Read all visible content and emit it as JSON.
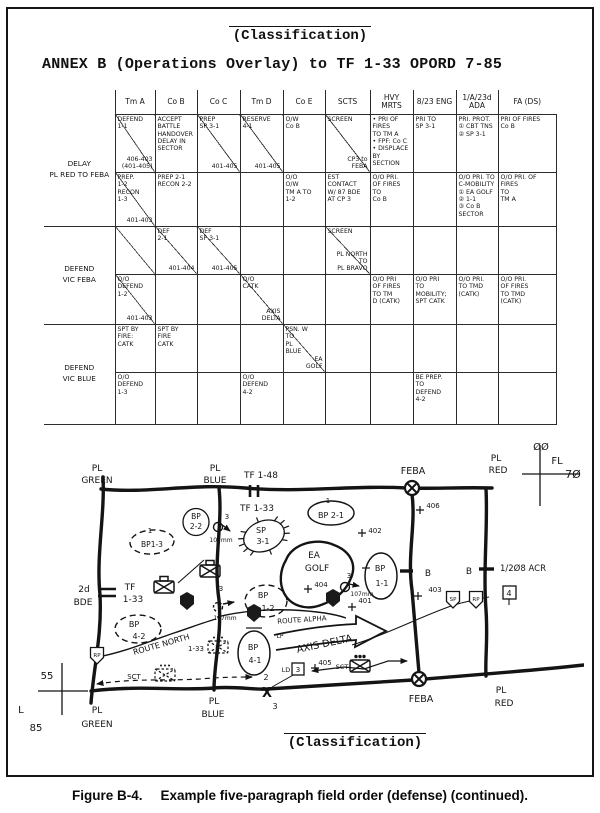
{
  "page": {
    "classification_top": "(Classification)",
    "classification_bottom": "(Classification)",
    "title": "ANNEX B (Operations Overlay) to TF 1-33 OPORD 7-85",
    "caption_label": "Figure B-4.",
    "caption_text": "Example five-paragraph field order (defense) (continued)."
  },
  "table": {
    "columns": [
      "Tm A",
      "Co B",
      "Co C",
      "Tm D",
      "Co E",
      "SCTS",
      "HVY\nMRTS",
      "8/23 ENG",
      "1/A/23d ADA",
      "FA (DS)"
    ],
    "rows": [
      {
        "label": "DELAY\nPL RED TO FEBA",
        "cells": [
          {
            "t": "DEFEND\n1-1",
            "b": "406-403\n(401-405)",
            "d": true
          },
          {
            "t": "ACCEPT\nBATTLE\nHANDOVER\nDELAY IN\nSECTOR"
          },
          {
            "t": "PREP\nSP 3-1",
            "b": "401-405",
            "d": true
          },
          {
            "t": "RESERVE\n4-1",
            "b": "401-405",
            "d": true
          },
          {
            "t": "O/W\nCo B"
          },
          {
            "t": "SCREEN",
            "b": "CP3 to\nFEBA",
            "d": true
          },
          {
            "t": "• PRI OF FIRES\n  TO TM A\n• FPF: Co C\n• DISPLACE BY\n  SECTION"
          },
          {
            "t": "PRI TO\nSP 3-1"
          },
          {
            "t": "PRI. PROT.\n① CBT TNS\n② SP 3-1"
          },
          {
            "t": "PRI OF FIRES\nCo B"
          }
        ]
      },
      {
        "label": "",
        "cells": [
          {
            "t": "PREP.\n1-2\nRECON\n1-3",
            "b": "401-403",
            "d": true
          },
          {
            "t": "PREP 2-1\nRECON 2-2"
          },
          {},
          {},
          {
            "t": "O/O\nO/W\nTM A TO\n1-2"
          },
          {
            "t": "EST CONTACT\nW/ 87 BDE\nAT CP 3"
          },
          {
            "t": "O/O PRI.\nOF FIRES\nTO\nCo B"
          },
          {},
          {
            "t": "O/O PRI. TO\nC-MOBILITY\n① EA GOLF\n② 1-1\n③ Co B SECTOR"
          },
          {
            "t": "O/O PRI. OF\nFIRES\nTO\nTM A"
          }
        ]
      },
      {
        "label": "DEFEND\nVIC FEBA",
        "cells": [
          {
            "d": true
          },
          {
            "t": "DEF\n2-1",
            "b": "401-404",
            "d": true
          },
          {
            "t": "DEF\nSP 3-1",
            "b": "401-405",
            "d": true
          },
          {},
          {},
          {
            "t": "SCREEN",
            "b": "PL NORTH\nTO\nPL BRAVO",
            "d": true
          },
          {},
          {},
          {},
          {}
        ]
      },
      {
        "label": "",
        "cells": [
          {
            "t": "O/O\nDEFEND\n1-2",
            "b": "401-403",
            "d": true
          },
          {},
          {},
          {
            "t": "O/O\nCATK",
            "b": "AXIS\nDELTA",
            "d": true
          },
          {},
          {},
          {
            "t": "O/O PRI\nOF FIRES\nTO TM\nD (CATK)"
          },
          {
            "t": "O/O PRI\nTO\nMOBILITY;\nSPT CATK"
          },
          {
            "t": "O/O PRI.\nTO TMD\n(CATK)"
          },
          {
            "t": "O/O PRI.\nOF FIRES\nTO TMD\n(CATK)"
          }
        ]
      },
      {
        "label": "DEFEND\nVIC BLUE",
        "cells": [
          {
            "t": "SPT BY\nFIRE:\nCATK"
          },
          {
            "t": "SPT BY\nFIRE\nCATK"
          },
          {},
          {},
          {
            "t": "PSN. W\nTO\nPL\nBLUE",
            "b": "EA\nGOLF",
            "d": true
          },
          {},
          {},
          {},
          {},
          {}
        ]
      },
      {
        "label": "",
        "cells": [
          {
            "t": "O/O\nDEFEND\n1-3"
          },
          {},
          {},
          {
            "t": "O/O DEFEND\n4-2"
          },
          {},
          {},
          {},
          {
            "t": "BE PREP.\nTO\nDEFEND\n4-2"
          },
          {},
          {}
        ]
      }
    ]
  },
  "map": {
    "texts": [
      {
        "t": "PL",
        "x": 97,
        "y": 471,
        "s": 9
      },
      {
        "t": "GREEN",
        "x": 97,
        "y": 483,
        "s": 9
      },
      {
        "t": "PL",
        "x": 215,
        "y": 471,
        "s": 9
      },
      {
        "t": "BLUE",
        "x": 215,
        "y": 483,
        "s": 9
      },
      {
        "t": "TF 1-48",
        "x": 261,
        "y": 478,
        "s": 9
      },
      {
        "t": "TF 1-33",
        "x": 257,
        "y": 511,
        "s": 9
      },
      {
        "t": "FEBA",
        "x": 413,
        "y": 474,
        "s": 9.5
      },
      {
        "t": "PL",
        "x": 496,
        "y": 461,
        "s": 9
      },
      {
        "t": "RED",
        "x": 498,
        "y": 473,
        "s": 9
      },
      {
        "t": "ØØ",
        "x": 541,
        "y": 450,
        "s": 10
      },
      {
        "t": "FL",
        "x": 557,
        "y": 464,
        "s": 10
      },
      {
        "t": "7Ø",
        "x": 573,
        "y": 478,
        "s": 11
      },
      {
        "t": "55",
        "x": 47,
        "y": 679,
        "s": 10
      },
      {
        "t": "FL",
        "x": 18,
        "y": 713,
        "s": 10
      },
      {
        "t": "85",
        "x": 36,
        "y": 731,
        "s": 10
      },
      {
        "t": "1",
        "x": 150,
        "y": 533,
        "s": 7
      },
      {
        "t": "BP1-3",
        "x": 152,
        "y": 547,
        "s": 7.5
      },
      {
        "t": "BP",
        "x": 196,
        "y": 519,
        "s": 7.5
      },
      {
        "t": "2-2",
        "x": 196,
        "y": 529,
        "s": 7.5
      },
      {
        "t": "3",
        "x": 227,
        "y": 519,
        "s": 7
      },
      {
        "t": "107mm",
        "x": 221,
        "y": 542,
        "s": 6
      },
      {
        "t": "SP",
        "x": 261,
        "y": 533,
        "s": 8
      },
      {
        "t": "3-1",
        "x": 263,
        "y": 544,
        "s": 8
      },
      {
        "t": "1",
        "x": 328,
        "y": 503,
        "s": 7
      },
      {
        "t": "BP 2-1",
        "x": 331,
        "y": 518,
        "s": 8
      },
      {
        "t": "402",
        "x": 375,
        "y": 533,
        "s": 7
      },
      {
        "t": "406",
        "x": 433,
        "y": 508,
        "s": 7
      },
      {
        "t": "EA",
        "x": 314,
        "y": 558,
        "s": 9
      },
      {
        "t": "GOLF",
        "x": 317,
        "y": 571,
        "s": 9
      },
      {
        "t": "BP",
        "x": 380,
        "y": 571,
        "s": 8
      },
      {
        "t": "1-1",
        "x": 382,
        "y": 586,
        "s": 8
      },
      {
        "t": "404",
        "x": 321,
        "y": 587,
        "s": 7
      },
      {
        "t": "3",
        "x": 349,
        "y": 578,
        "s": 7
      },
      {
        "t": "107mm",
        "x": 362,
        "y": 596,
        "s": 6
      },
      {
        "t": "401",
        "x": 365,
        "y": 603,
        "s": 7
      },
      {
        "t": "BP",
        "x": 263,
        "y": 598,
        "s": 8
      },
      {
        "t": "1-2",
        "x": 268,
        "y": 611,
        "s": 8
      },
      {
        "t": "2d",
        "x": 84,
        "y": 592,
        "s": 9
      },
      {
        "t": "BDE",
        "x": 83,
        "y": 605,
        "s": 9
      },
      {
        "t": "TF",
        "x": 130,
        "y": 590,
        "s": 9
      },
      {
        "t": "1-33",
        "x": 133,
        "y": 602,
        "s": 9
      },
      {
        "t": "BP",
        "x": 134,
        "y": 627,
        "s": 8
      },
      {
        "t": "4-2",
        "x": 139,
        "y": 639,
        "s": 8
      },
      {
        "t": "3",
        "x": 221,
        "y": 591,
        "s": 7
      },
      {
        "t": "107mm",
        "x": 225,
        "y": 620,
        "s": 6
      },
      {
        "t": "ROUTE NORTH",
        "x": 162,
        "y": 647,
        "s": 8,
        "r": -16
      },
      {
        "t": "1-33",
        "x": 196,
        "y": 651,
        "s": 7
      },
      {
        "t": "SCT",
        "x": 134,
        "y": 679,
        "s": 7
      },
      {
        "t": "ROUTE ALPHA",
        "x": 302,
        "y": 622,
        "s": 7,
        "r": -4
      },
      {
        "t": "LP",
        "x": 280,
        "y": 638,
        "s": 6
      },
      {
        "t": "AXIS DELTA",
        "x": 325,
        "y": 647,
        "s": 10,
        "r": -12
      },
      {
        "t": "BP",
        "x": 253,
        "y": 650,
        "s": 8
      },
      {
        "t": "4-1",
        "x": 255,
        "y": 663,
        "s": 8
      },
      {
        "t": "LD",
        "x": 286,
        "y": 672,
        "s": 6.5
      },
      {
        "t": "3",
        "x": 298,
        "y": 672,
        "s": 7
      },
      {
        "t": "405",
        "x": 325,
        "y": 665,
        "s": 7
      },
      {
        "t": "SCT",
        "x": 342,
        "y": 669,
        "s": 6.5
      },
      {
        "t": "B",
        "x": 428,
        "y": 576,
        "s": 9
      },
      {
        "t": "B",
        "x": 469,
        "y": 574,
        "s": 9
      },
      {
        "t": "1/2Ø8 ACR",
        "x": 500,
        "y": 571,
        "s": 8.5,
        "a": "start"
      },
      {
        "t": "4",
        "x": 509,
        "y": 596,
        "s": 8
      },
      {
        "t": "403",
        "x": 435,
        "y": 592,
        "s": 7
      },
      {
        "t": "SP",
        "x": 453,
        "y": 601,
        "s": 5.5
      },
      {
        "t": "RP",
        "x": 476,
        "y": 601,
        "s": 5.5
      },
      {
        "t": "RP",
        "x": 97,
        "y": 657,
        "s": 5.5
      },
      {
        "t": "2",
        "x": 266,
        "y": 680,
        "s": 8
      },
      {
        "t": "X",
        "x": 267,
        "y": 697,
        "s": 13,
        "w": 700
      },
      {
        "t": "3",
        "x": 275,
        "y": 709,
        "s": 8
      },
      {
        "t": "FEBA",
        "x": 421,
        "y": 702,
        "s": 9.5
      },
      {
        "t": "PL",
        "x": 501,
        "y": 693,
        "s": 9
      },
      {
        "t": "RED",
        "x": 504,
        "y": 706,
        "s": 9
      },
      {
        "t": "PL",
        "x": 214,
        "y": 704,
        "s": 9
      },
      {
        "t": "BLUE",
        "x": 213,
        "y": 717,
        "s": 9
      },
      {
        "t": "PL",
        "x": 97,
        "y": 713,
        "s": 9
      },
      {
        "t": "GREEN",
        "x": 97,
        "y": 727,
        "s": 9
      }
    ]
  }
}
